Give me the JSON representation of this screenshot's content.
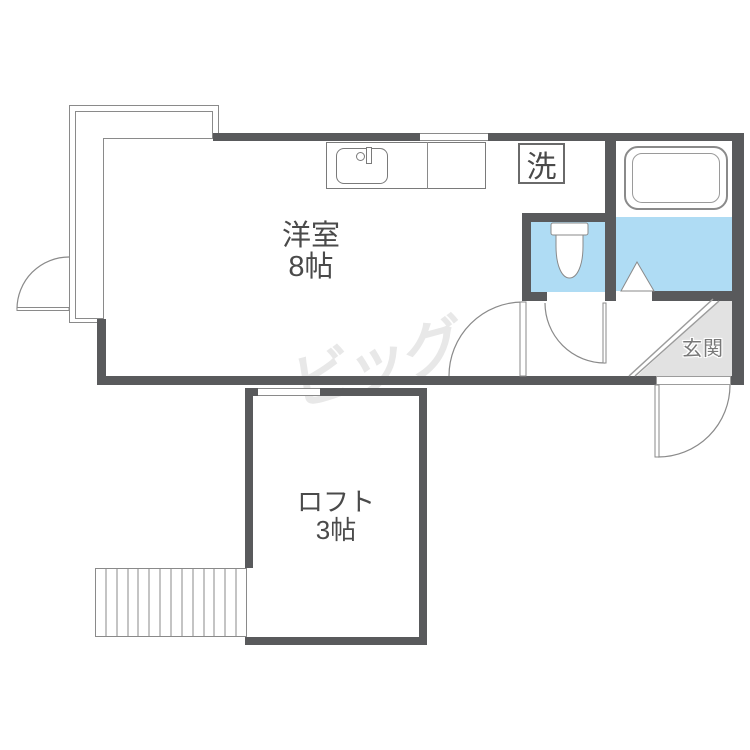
{
  "floorplan": {
    "watermark": "ビッグ",
    "labels": {
      "main_room_name": "洋室",
      "main_room_size": "8帖",
      "loft_name": "ロフト",
      "loft_size": "3帖",
      "entrance": "玄関",
      "laundry": "洗"
    },
    "theme": {
      "wall": "#595A5C",
      "water_blue": "#AFDCF4",
      "genkan_gray": "#E2E2E2",
      "line": "#8A8A8A",
      "line_light": "#9C9C9C",
      "text": "#4A4A4A",
      "genkan_text": "#787878",
      "watermark_color": "#E8E8E8",
      "bg": "#FFFFFF"
    }
  }
}
